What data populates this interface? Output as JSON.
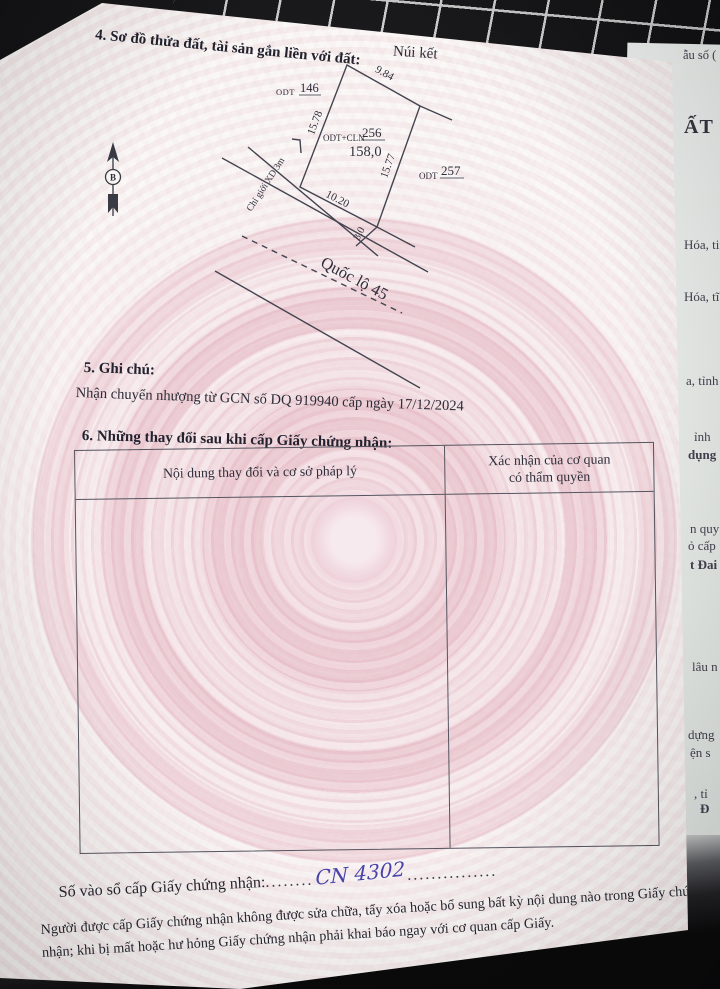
{
  "document": {
    "section4_title": "4. Sơ đồ thửa đất, tài sản gắn liền với đất:",
    "diagram": {
      "place_label": "Núi kết",
      "north_label": "B",
      "adjacent_left": {
        "type": "ODT",
        "number": "146"
      },
      "parcel": {
        "type": "ODT+CLN",
        "number": "256",
        "area": "158,0"
      },
      "adjacent_right": {
        "type": "ODT",
        "number": "257"
      },
      "edges": {
        "top": "9.84",
        "left": "15.78",
        "right": "15.77",
        "bottom": "10.20",
        "setback": "3.0"
      },
      "boundary_label": "Chỉ giới XD 3m",
      "road_label": "Quốc lộ 45"
    },
    "section5_title": "5. Ghi chú:",
    "section5_note": "Nhận chuyển nhượng từ GCN số DQ 919940 cấp ngày 17/12/2024",
    "section6_title": "6. Những thay đổi sau khi cấp Giấy chứng nhận:",
    "table": {
      "col1_header": "Nội dung thay đổi và cơ sở pháp lý",
      "col2_header_line1": "Xác nhận của cơ quan",
      "col2_header_line2": "có thẩm quyền"
    },
    "registry": {
      "label": "Số vào sổ cấp Giấy chứng nhận:",
      "dots_left": "........",
      "value": "CN 4302",
      "dots_right": "..............."
    },
    "footer": "Người được cấp Giấy chứng nhận không được sửa chữa, tẩy xóa hoặc bổ sung bất kỳ nội dung nào trong Giấy chứng nhận; khi bị mất hoặc hư hỏng Giấy chứng nhận phải khai báo ngay với cơ quan cấp Giấy."
  },
  "underlying_page_fragments": [
    {
      "text": "ẫu số ("
    },
    {
      "text": "ẤT"
    },
    {
      "text": "Hóa, tin"
    },
    {
      "text": "Hóa, tĩ"
    },
    {
      "text": "a, tỉnh"
    },
    {
      "text": "ỉnh"
    },
    {
      "text": "dụng"
    },
    {
      "text": "n quy"
    },
    {
      "text": "ỏ cấp"
    },
    {
      "text": "t Đai"
    },
    {
      "text": "lâu n"
    },
    {
      "text": "dựng"
    },
    {
      "text": "ện s"
    },
    {
      "text": ", tỉ"
    },
    {
      "text": "Đ"
    }
  ],
  "colors": {
    "ink": "#2b2b36",
    "handwriting_ink": "#4743a8",
    "page_pink": "#eccdd5",
    "backdrop": "#1a1a1c"
  }
}
